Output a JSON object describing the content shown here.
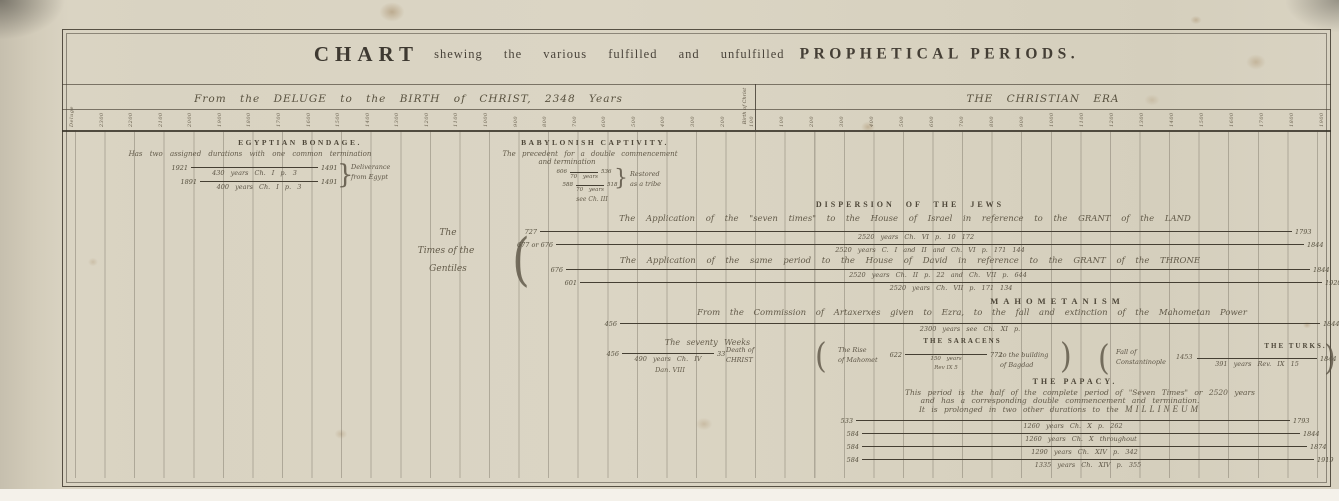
{
  "title": {
    "chart": "CHART",
    "middle": "shewing the various fulfilled and unfulfilled",
    "tail": "PROPHETICAL PERIODS."
  },
  "era": {
    "left": "From the DELUGE to the BIRTH of CHRIST, 2348 Years",
    "right": "THE CHRISTIAN ERA",
    "divider": "Birth of Christ"
  },
  "ticks": {
    "bc": [
      "Deluge",
      "2300",
      "2200",
      "2100",
      "2000",
      "1900",
      "1800",
      "1700",
      "1600",
      "1500",
      "1400",
      "1300",
      "1200",
      "1100",
      "1000",
      "900",
      "800",
      "700",
      "600",
      "500",
      "400",
      "300",
      "200",
      "100"
    ],
    "ad": [
      "100",
      "200",
      "300",
      "400",
      "500",
      "600",
      "700",
      "800",
      "900",
      "1000",
      "1100",
      "1200",
      "1300",
      "1400",
      "1500",
      "1600",
      "1700",
      "1800",
      "1900"
    ]
  },
  "egyptian": {
    "header": "EGYPTIAN BONDAGE.",
    "sub": "Has two assigned durations with one common termination",
    "line1": {
      "start": "1921",
      "end": "1491",
      "label": "430 years  Ch. I  p. 3"
    },
    "line2": {
      "start": "1891",
      "end": "1491",
      "label": "400 years  Ch. I  p. 3"
    },
    "brace": "}",
    "note1": "Deliverance",
    "note2": "from Egypt"
  },
  "babylonish": {
    "header": "BABYLONISH CAPTIVITY.",
    "sub1": "The precedent for a double commencement",
    "sub2": "and termination",
    "line1": {
      "start": "606",
      "end": "536",
      "label": "70 years"
    },
    "line2": {
      "start": "588",
      "end": "518",
      "label": "70 years"
    },
    "ref": "see Ch. III",
    "brace": "}",
    "note1": "Restored",
    "note2": "as a tribe"
  },
  "gentiles": {
    "l1": "The",
    "l2": "Times of the",
    "l3": "Gentiles",
    "paren": "("
  },
  "dispersion": {
    "header": "DISPERSION OF THE JEWS",
    "app1": "The Application of the \"seven times\" to the House of Israel in reference to the GRANT of the LAND",
    "app2": "The Application of the same period to the House of David in reference to the GRANT of the THRONE",
    "line1": {
      "start": "727",
      "end": "1793",
      "ann": "2520 years   Ch. VI  p. 10   172"
    },
    "line2": {
      "start": "677 or 676",
      "end": "1844",
      "ann": "2520 years   C. I and II  and  Ch. VI  p. 171  144"
    },
    "line3": {
      "start": "676",
      "end": "1844",
      "ann": "2520 years   Ch. II  p. 22  and  Ch. VII  p. 644"
    },
    "line4": {
      "start": "601",
      "end": "1920",
      "ann": "2520 years   Ch. VII  p. 171   134"
    }
  },
  "mahometanism": {
    "header": "MAHOMETANISM",
    "sub": "From the Commission of Artaxerxes given to Ezra, to the fall and extinction of the Mahometan Power",
    "line": {
      "start": "456",
      "end": "1844",
      "ann": "2300 years   see  Ch. XI  p."
    }
  },
  "weeks": {
    "title": "The seventy Weeks",
    "line": {
      "start": "456",
      "end": "33",
      "label1": "490 years   Ch. IV",
      "label2": "Dan. VIII"
    },
    "note1": "Death of",
    "note2": "CHRIST"
  },
  "saracens": {
    "header": "THE SARACENS",
    "rise1": "The Rise",
    "rise2": "of Mahomet",
    "line": {
      "start": "622",
      "end": "772",
      "label1": "150 years",
      "label2": "Rev IX 5"
    },
    "note1": "to the building",
    "note2": "of Bagdad",
    "paren_open": "(",
    "paren_close": ")"
  },
  "turks": {
    "header": "THE TURKS.",
    "fall1": "Fall of",
    "fall2": "Constantinople",
    "year": "1453",
    "line": {
      "end": "1844",
      "label": "391 years    Rev. IX 15"
    },
    "paren_open": "(",
    "paren_close": ")"
  },
  "papacy": {
    "header": "THE PAPACY.",
    "d1": "This period is the half of the complete period of \"Seven Times\" or 2520 years",
    "d2": "and has a corresponding double commencement and termination.",
    "d3": "It is prolonged in two other durations to the",
    "d3b": "MILLINEUM",
    "line1": {
      "start": "533",
      "end": "1793",
      "ann": "1260 years    Ch. X  p. 262"
    },
    "line2": {
      "start": "584",
      "end": "1844",
      "ann": "1260 years    Ch. X  throughout"
    },
    "line3": {
      "start": "584",
      "end": "1874",
      "ann": "1290 years    Ch. XIV  p. 342"
    },
    "line4": {
      "start": "584",
      "end": "1919",
      "ann": "1335 years    Ch. XIV  p. 355"
    }
  },
  "chart_data": {
    "type": "timeline",
    "title": "CHART shewing the various fulfilled and unfulfilled PROPHETICAL PERIODS.",
    "axis": {
      "left_era": "From the DELUGE to the BIRTH of CHRIST, 2348 Years",
      "right_era": "THE CHRISTIAN ERA",
      "divider": "Birth of Christ",
      "bc_ticks_every": 100,
      "ad_ticks_every": 100
    },
    "periods": [
      {
        "group": "Egyptian Bondage",
        "from": "1921 BC",
        "to": "1491 BC",
        "duration": "430 years",
        "ref": "Ch. I p. 3",
        "note": "Deliverance from Egypt"
      },
      {
        "group": "Egyptian Bondage",
        "from": "1891 BC",
        "to": "1491 BC",
        "duration": "400 years",
        "ref": "Ch. I p. 3",
        "note": "Deliverance from Egypt"
      },
      {
        "group": "Babylonish Captivity",
        "from": "606 BC",
        "to": "536 BC",
        "duration": "70 years",
        "ref": "see Ch. III",
        "note": "Restored as a tribe"
      },
      {
        "group": "Dispersion of the Jews — House of Israel, Grant of the Land",
        "from": "727 BC",
        "to": "AD 1793",
        "duration": "2520 years",
        "ref": "Ch. VI p. 10 172"
      },
      {
        "group": "Dispersion of the Jews — House of Israel, Grant of the Land",
        "from": "677 or 676 BC",
        "to": "AD 1844",
        "duration": "2520 years",
        "ref": "C. I and II and Ch. VI p. 171 144"
      },
      {
        "group": "Dispersion of the Jews — House of David, Grant of the Throne",
        "from": "676 BC",
        "to": "AD 1844",
        "duration": "2520 years",
        "ref": "Ch. II p. 22 and Ch. VII p. 644"
      },
      {
        "group": "Dispersion of the Jews — House of David, Grant of the Throne",
        "from": "601 BC",
        "to": "AD 1920",
        "duration": "2520 years",
        "ref": "Ch. VII p. 171 134"
      },
      {
        "group": "Mahometanism",
        "from": "456 BC",
        "to": "AD 1844",
        "duration": "2300 years",
        "ref": "see Ch. XI"
      },
      {
        "group": "The Seventy Weeks",
        "from": "456 BC",
        "to": "AD 33 — Death of CHRIST",
        "duration": "490 years",
        "ref": "Ch. IV, Dan. VIII"
      },
      {
        "group": "The Saracens",
        "from": "AD 622 — The Rise of Mahomet",
        "to": "AD 772 — to the building of Bagdad",
        "duration": "150 years",
        "ref": "Rev IX 5"
      },
      {
        "group": "The Turks",
        "from": "AD 1453 — Fall of Constantinople",
        "to": "AD 1844",
        "duration": "391 years",
        "ref": "Rev. IX 15"
      },
      {
        "group": "The Papacy",
        "from": "AD 533",
        "to": "AD 1793",
        "duration": "1260 years",
        "ref": "Ch. X p. 262"
      },
      {
        "group": "The Papacy",
        "from": "AD 584",
        "to": "AD 1844",
        "duration": "1260 years",
        "ref": "Ch. X throughout"
      },
      {
        "group": "The Papacy",
        "from": "AD 584",
        "to": "AD 1874",
        "duration": "1290 years",
        "ref": "Ch. XIV p. 342"
      },
      {
        "group": "The Papacy",
        "from": "AD 584",
        "to": "AD 1919",
        "duration": "1335 years",
        "ref": "Ch. XIV p. 355"
      }
    ]
  }
}
